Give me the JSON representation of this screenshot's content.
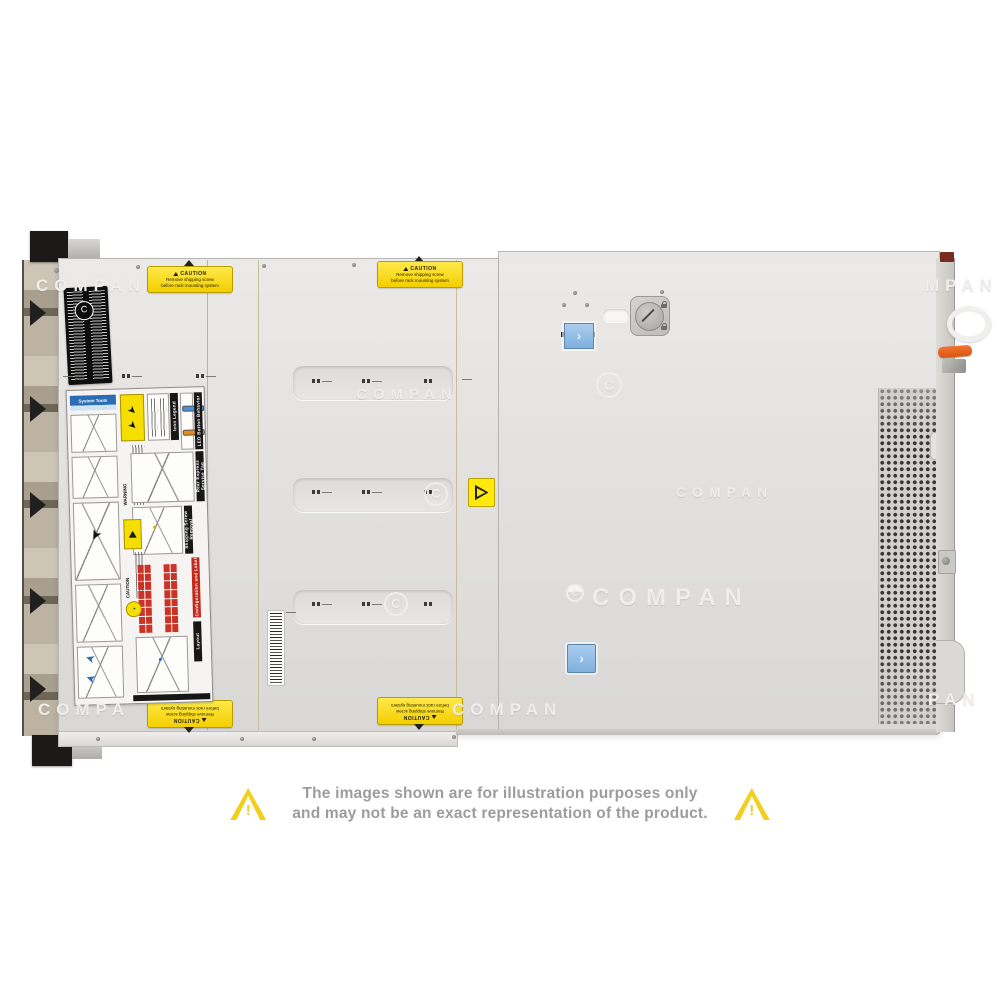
{
  "page": {
    "background_color": "#ffffff"
  },
  "product_photo": {
    "subject": "rack server top view",
    "watermark_text": "COMPAN",
    "watermarks": [
      "COMPAN",
      "COMPAN",
      "COMPAN",
      "COMPAN",
      "COMPA",
      "COMPAN",
      "MPAN",
      "PAN"
    ],
    "watermark_c": "C",
    "caution_sticker": {
      "title": "CAUTION",
      "line1": "Remove shipping screw",
      "line2": "before rack mounting system"
    },
    "service_label": {
      "system_tools": "System Tools",
      "icon_legend": "Icon Legend",
      "led_button_behavior": "LED Button Behavior",
      "warning": "WARNING",
      "shipping_screw_removal": "Shipping Screw Removal",
      "caution": "CAUTION",
      "configuration_and_label": "Configuration and Label",
      "layout": "Layout",
      "rear_express_service_tag": "Rear Express Service Tag"
    },
    "latch": {
      "chevron": "›"
    },
    "colors": {
      "sticker_yellow": "#f8e000",
      "latch_blue": "#8fbce6",
      "led_blue": "#4a90d9",
      "led_orange": "#e8891a",
      "label_red": "#cc3327",
      "lever_orange": "#e2601c",
      "disclaimer_gray": "#9c9c9c",
      "triangle_yellow": "#f2cf1d"
    }
  },
  "disclaimer": {
    "line1": "The images shown are for illustration purposes only",
    "line2": "and may not be an exact representation of the product."
  }
}
